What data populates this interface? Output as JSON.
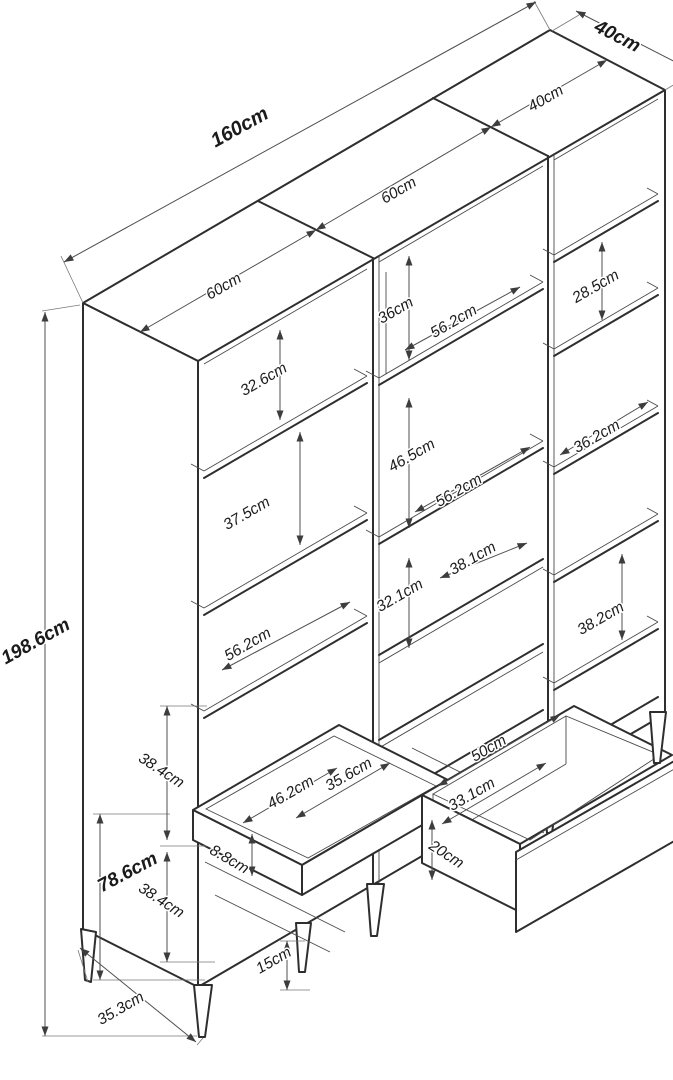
{
  "diagram": {
    "kind": "furniture-dimension-drawing",
    "unit": "cm",
    "colors": {
      "background": "#ffffff",
      "structure_line": "#2e2e2e",
      "dimension_line": "#4f4f4f",
      "label_text": "#1b1b1b"
    }
  },
  "dimensions": [
    {
      "id": "160",
      "text": "160cm",
      "x": 240,
      "y": 128,
      "rot": -29,
      "bold": true,
      "size": 20
    },
    {
      "id": "40-depth",
      "text": "40cm",
      "x": 617,
      "y": 37,
      "rot": 27,
      "bold": true,
      "size": 19
    },
    {
      "id": "60-left",
      "text": "60cm",
      "x": 224,
      "y": 287,
      "rot": -30,
      "bold": false,
      "size": 15.5
    },
    {
      "id": "60-mid",
      "text": "60cm",
      "x": 399,
      "y": 191,
      "rot": -30,
      "bold": false,
      "size": 15.5
    },
    {
      "id": "40-right",
      "text": "40cm",
      "x": 546,
      "y": 99,
      "rot": -30,
      "bold": false,
      "size": 15.5
    },
    {
      "id": "198-6",
      "text": "198.6cm",
      "x": 36,
      "y": 642,
      "rot": -29,
      "bold": true,
      "size": 19
    },
    {
      "id": "32-6",
      "text": "32.6cm",
      "x": 264,
      "y": 380,
      "rot": -30,
      "bold": false,
      "size": 15.5
    },
    {
      "id": "37-5",
      "text": "37.5cm",
      "x": 247,
      "y": 514,
      "rot": -30,
      "bold": false,
      "size": 15.5
    },
    {
      "id": "56-2-left",
      "text": "56.2cm",
      "x": 248,
      "y": 645,
      "rot": -30,
      "bold": false,
      "size": 15.5
    },
    {
      "id": "36",
      "text": "36cm",
      "x": 396,
      "y": 311,
      "rot": -30,
      "bold": false,
      "size": 15.5
    },
    {
      "id": "56-2-upper",
      "text": "56.2cm",
      "x": 454,
      "y": 322,
      "rot": -30,
      "bold": false,
      "size": 15.5
    },
    {
      "id": "46-5",
      "text": "46.5cm",
      "x": 412,
      "y": 456,
      "rot": -30,
      "bold": false,
      "size": 15.5
    },
    {
      "id": "56-2-lower",
      "text": "56.2cm",
      "x": 459,
      "y": 491,
      "rot": -30,
      "bold": false,
      "size": 15.5
    },
    {
      "id": "38-1",
      "text": "38.1cm",
      "x": 473,
      "y": 559,
      "rot": -30,
      "bold": false,
      "size": 15.5
    },
    {
      "id": "32-1",
      "text": "32.1cm",
      "x": 400,
      "y": 596,
      "rot": -30,
      "bold": false,
      "size": 15.5
    },
    {
      "id": "28-5",
      "text": "28.5cm",
      "x": 596,
      "y": 287,
      "rot": -30,
      "bold": false,
      "size": 15.5
    },
    {
      "id": "36-2",
      "text": "36.2cm",
      "x": 597,
      "y": 437,
      "rot": -30,
      "bold": false,
      "size": 15.5
    },
    {
      "id": "38-2",
      "text": "38.2cm",
      "x": 601,
      "y": 619,
      "rot": -30,
      "bold": false,
      "size": 15.5
    },
    {
      "id": "38-4-upper",
      "text": "38.4cm",
      "x": 161,
      "y": 771,
      "rot": 33,
      "bold": false,
      "size": 15.5
    },
    {
      "id": "78-6",
      "text": "78.6cm",
      "x": 128,
      "y": 873,
      "rot": -28,
      "bold": true,
      "size": 19
    },
    {
      "id": "38-4-lower",
      "text": "38.4cm",
      "x": 161,
      "y": 901,
      "rot": 33,
      "bold": false,
      "size": 15.5
    },
    {
      "id": "8-8",
      "text": "8.8cm",
      "x": 229,
      "y": 860,
      "rot": 30,
      "bold": false,
      "size": 15.5
    },
    {
      "id": "46-2",
      "text": "46.2cm",
      "x": 291,
      "y": 793,
      "rot": -30,
      "bold": false,
      "size": 15.5
    },
    {
      "id": "35-6",
      "text": "35.6cm",
      "x": 349,
      "y": 775,
      "rot": -30,
      "bold": false,
      "size": 15.5
    },
    {
      "id": "50",
      "text": "50cm",
      "x": 489,
      "y": 749,
      "rot": -30,
      "bold": false,
      "size": 15.5
    },
    {
      "id": "33-1",
      "text": "33.1cm",
      "x": 472,
      "y": 795,
      "rot": -30,
      "bold": false,
      "size": 15.5
    },
    {
      "id": "20",
      "text": "20cm",
      "x": 446,
      "y": 855,
      "rot": 33,
      "bold": false,
      "size": 15.5
    },
    {
      "id": "15",
      "text": "15cm",
      "x": 274,
      "y": 961,
      "rot": -30,
      "bold": false,
      "size": 15.5
    },
    {
      "id": "35-3",
      "text": "35.3cm",
      "x": 121,
      "y": 1009,
      "rot": -30,
      "bold": false,
      "size": 15.5
    }
  ]
}
